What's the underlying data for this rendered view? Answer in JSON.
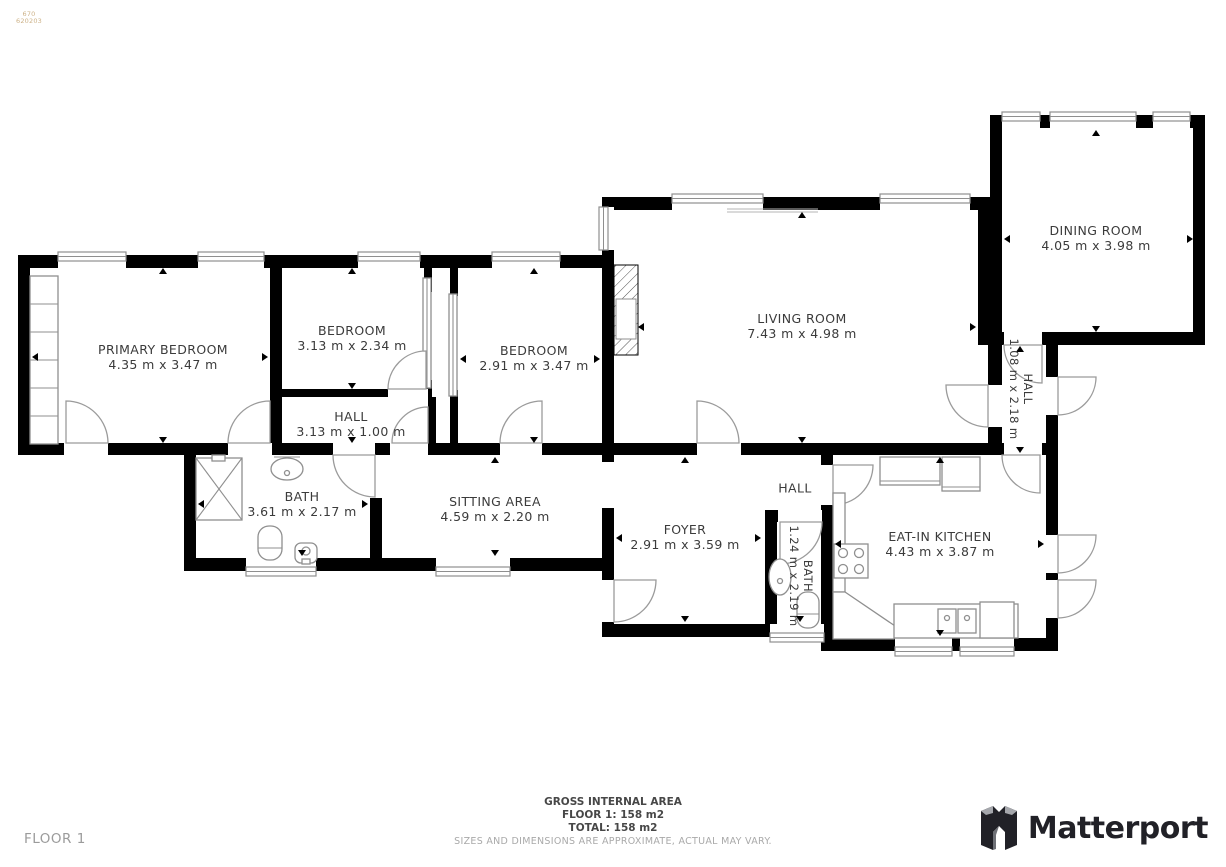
{
  "watermark": {
    "line1": "670",
    "line2": "620203"
  },
  "rooms": [
    {
      "name": "PRIMARY BEDROOM",
      "dims": "4.35 m x 3.47 m"
    },
    {
      "name": "BEDROOM",
      "dims": "3.13 m x 2.34 m"
    },
    {
      "name": "BEDROOM",
      "dims": "2.91 m x 3.47 m"
    },
    {
      "name": "HALL",
      "dims": "3.13 m x 1.00 m"
    },
    {
      "name": "LIVING ROOM",
      "dims": "7.43 m x 4.98 m"
    },
    {
      "name": "DINING ROOM",
      "dims": "4.05 m x 3.98 m"
    },
    {
      "name": "HALL",
      "dims": "1.08 m x 2.18 m"
    },
    {
      "name": "BATH",
      "dims": "3.61 m x 2.17 m"
    },
    {
      "name": "SITTING AREA",
      "dims": "4.59 m x 2.20 m"
    },
    {
      "name": "FOYER",
      "dims": "2.91 m x 3.59 m"
    },
    {
      "name": "HALL",
      "dims": ""
    },
    {
      "name": "BATH",
      "dims": "1.24 m x 2.19 m"
    },
    {
      "name": "EAT-IN KITCHEN",
      "dims": "4.43 m x 3.87 m"
    }
  ],
  "footer": {
    "title": "GROSS INTERNAL AREA",
    "floor_line": "FLOOR 1: 158 m2",
    "total_line": "TOTAL: 158 m2",
    "disclaimer": "SIZES AND DIMENSIONS ARE APPROXIMATE, ACTUAL MAY VARY."
  },
  "floor_label": "FLOOR 1",
  "brand": {
    "name": "Matterport"
  },
  "colors": {
    "wall": "#000000",
    "fixture_stroke": "#8f8f8f",
    "label_text": "#3b3b3b",
    "footer_text": "#474747",
    "muted_text": "#a9a9a9",
    "watermark": "#cdb288",
    "brand": "#212127"
  }
}
